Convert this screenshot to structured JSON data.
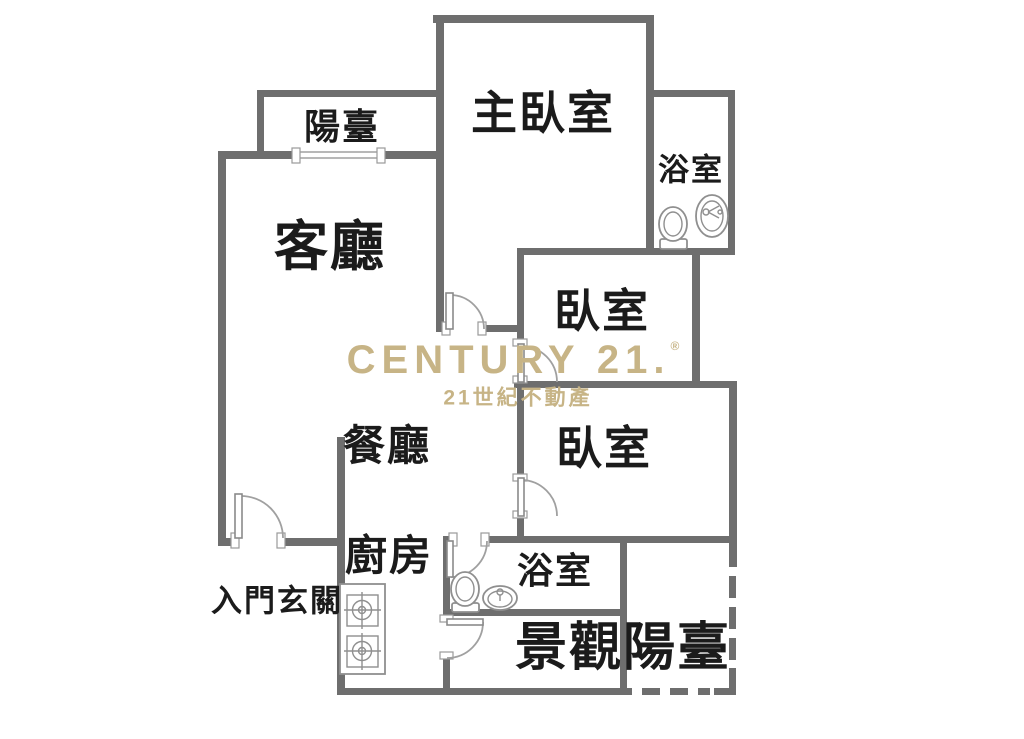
{
  "floorplan": {
    "rooms": {
      "balcony_top": "陽臺",
      "master_bedroom": "主臥室",
      "bathroom_top": "浴室",
      "living_room": "客廳",
      "bedroom_1": "臥室",
      "bedroom_2": "臥室",
      "dining_room": "餐廳",
      "kitchen": "廚房",
      "entrance": "入門玄關",
      "bathroom_bottom": "浴室",
      "view_balcony": "景觀陽臺"
    },
    "watermark": {
      "brand": "CENTURY 21.",
      "registered": "®",
      "subtitle": "21世紀不動產"
    },
    "colors": {
      "wall": "#6e6e6e",
      "fixture": "#8f8f8f",
      "label": "#1b1b1b",
      "brand": "#c7b486",
      "background": "#ffffff"
    }
  }
}
